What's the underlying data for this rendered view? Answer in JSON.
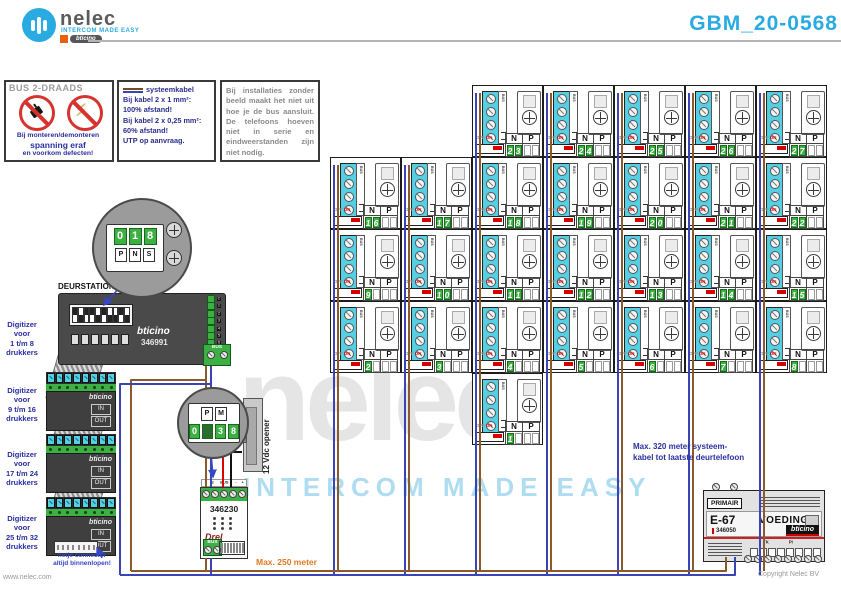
{
  "header": {
    "brand": "nelec",
    "brand_tagline": "intercom made easy",
    "brand_sub": "bticino",
    "title": "GBM_20-0568"
  },
  "box_bus": {
    "title": "BUS 2-DRAADS",
    "lines": [
      "Bij monteren/demonteren",
      "spanning eraf",
      "en voorkom defecten!"
    ]
  },
  "box_kabel": {
    "legend": "systeemkabel",
    "lines": [
      "Bij kabel 2 x 1 mm²:",
      "100% afstand!",
      "Bij kabel 2 x 0,25 mm²:",
      "60% afstand!",
      "UTP op aanvraag."
    ]
  },
  "box_zonder": {
    "text": "Bij installaties zonder beeld maakt het niet uit hoe je de bus aansluit. De telefoons hoeven niet in serie en eindweerstanden zijn niet nodig."
  },
  "deurstation": {
    "label": "DEURSTATION 2-18A",
    "brand": "bticino",
    "part": "346991",
    "bus": "BUS",
    "terminals": [
      "C",
      "1",
      "2",
      "3",
      "4",
      "5",
      "6",
      "7",
      "8"
    ]
  },
  "inset1": {
    "digits": [
      "0",
      "1",
      "8"
    ],
    "dials": [
      "P",
      "N",
      "S"
    ]
  },
  "inset2": {
    "dials": [
      "P",
      "M"
    ],
    "digits": [
      "0",
      "3",
      "8"
    ]
  },
  "digitizers": {
    "labels": [
      [
        "Digitizer",
        "voor",
        "1 t/m 8",
        "drukkers"
      ],
      [
        "Digitizer",
        "voor",
        "9 t/m 16",
        "drukkers"
      ],
      [
        "Digitizer",
        "voor",
        "17 t/m 24",
        "drukkers"
      ],
      [
        "Digitizer",
        "voor",
        "25 t/m 32",
        "drukkers"
      ]
    ],
    "brand": "bticino",
    "in_label": "IN",
    "out_label": "OUT",
    "note": [
      "netje connector",
      "altijd binnenlopen!"
    ]
  },
  "module346230": {
    "part": "346230",
    "top_labels": [
      "1",
      "2",
      "BUS",
      "-",
      "+"
    ],
    "text": "Drel",
    "bus": "BUS"
  },
  "opener": {
    "label": "12 Vdc opener"
  },
  "distances": {
    "bottom": "Max. 250 meter",
    "right": [
      "Max. 320 meter systeem-",
      "kabel tot laatste deurtelefoon"
    ]
  },
  "voeding": {
    "primair": "PRIMAIR",
    "model": "E-67",
    "name": "VOEDING",
    "part": "346050",
    "brand": "bticino",
    "tk": "TK",
    "pi": "PI"
  },
  "phones": {
    "n": "N",
    "p": "P",
    "off": "OFF",
    "on": "ON",
    "bus": "BUS",
    "units": [
      {
        "num": "1",
        "row": 4,
        "col": 2
      },
      {
        "num": "2",
        "row": 3,
        "col": 0
      },
      {
        "num": "3",
        "row": 3,
        "col": 1
      },
      {
        "num": "4",
        "row": 3,
        "col": 2
      },
      {
        "num": "5",
        "row": 3,
        "col": 3
      },
      {
        "num": "6",
        "row": 3,
        "col": 4
      },
      {
        "num": "7",
        "row": 3,
        "col": 5
      },
      {
        "num": "8",
        "row": 3,
        "col": 6
      },
      {
        "num": "9",
        "row": 2,
        "col": 0
      },
      {
        "num": "10",
        "row": 2,
        "col": 1
      },
      {
        "num": "11",
        "row": 2,
        "col": 2
      },
      {
        "num": "12",
        "row": 2,
        "col": 3
      },
      {
        "num": "13",
        "row": 2,
        "col": 4
      },
      {
        "num": "14",
        "row": 2,
        "col": 5
      },
      {
        "num": "15",
        "row": 2,
        "col": 6
      },
      {
        "num": "16",
        "row": 1,
        "col": 0
      },
      {
        "num": "17",
        "row": 1,
        "col": 1
      },
      {
        "num": "18",
        "row": 1,
        "col": 2
      },
      {
        "num": "19",
        "row": 1,
        "col": 3
      },
      {
        "num": "20",
        "row": 1,
        "col": 4
      },
      {
        "num": "21",
        "row": 1,
        "col": 5
      },
      {
        "num": "22",
        "row": 1,
        "col": 6
      },
      {
        "num": "23",
        "row": 0,
        "col": 2
      },
      {
        "num": "24",
        "row": 0,
        "col": 3
      },
      {
        "num": "25",
        "row": 0,
        "col": 4
      },
      {
        "num": "26",
        "row": 0,
        "col": 5
      },
      {
        "num": "27",
        "row": 0,
        "col": 6
      }
    ]
  },
  "watermark": {
    "big": "nelec",
    "sub": "INTERCOM MADE EASY"
  },
  "footer": {
    "site": "www.nelec.com",
    "copyright": "Copyright Nelec BV"
  },
  "colors": {
    "accent": "#29ABE2",
    "green": "#3CB043",
    "wire_brown": "#8a5a2a",
    "wire_blue": "#3a44b4",
    "wire_red": "#dd0000",
    "wire_black": "#111111",
    "navy": "#2b2f9f",
    "orange": "#e07820"
  }
}
